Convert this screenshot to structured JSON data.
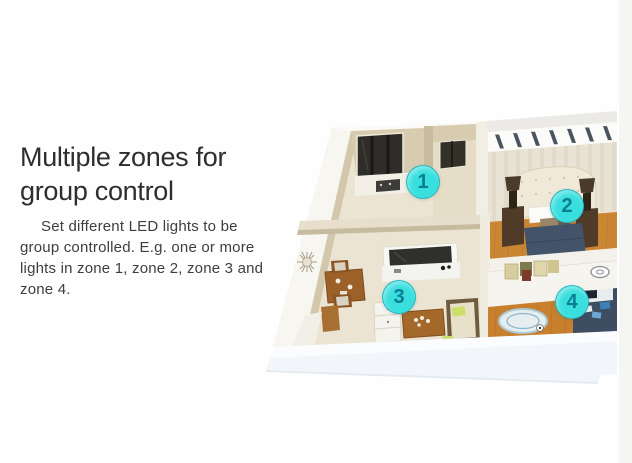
{
  "page": {
    "title_lines": [
      "Multiple zones for",
      "group control"
    ],
    "description_lines": [
      "Set different LED lights to be",
      "group controlled. E.g. one or more",
      "lights in zone 1, zone 2, zone 3 and",
      "zone 4."
    ]
  },
  "zones": [
    {
      "label": "1"
    },
    {
      "label": "2"
    },
    {
      "label": "3"
    },
    {
      "label": "4"
    }
  ],
  "colors": {
    "zone_marker_fill": "#39dfde",
    "zone_marker_text": "#0b7d92"
  }
}
